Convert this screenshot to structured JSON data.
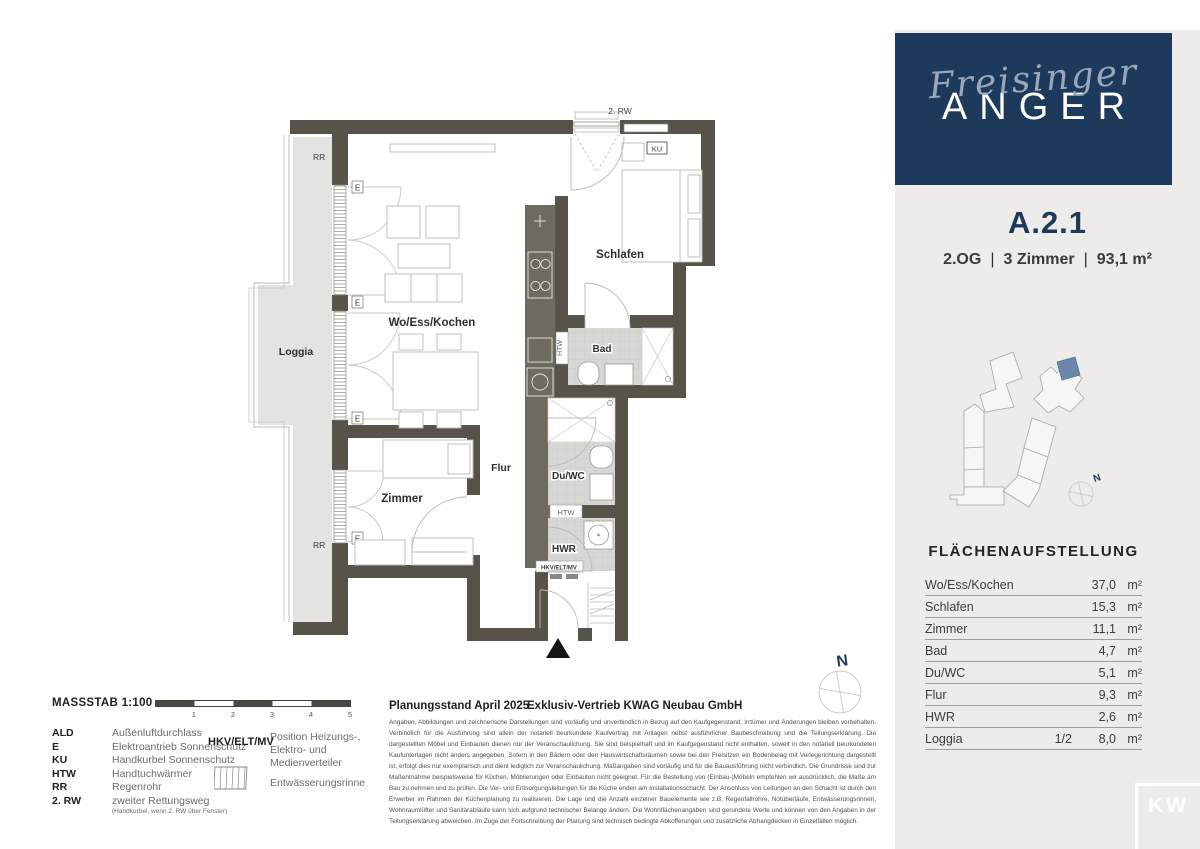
{
  "brand": {
    "script": "Freisinger",
    "caps": "ANGER"
  },
  "unit": {
    "id": "A.2.1",
    "floor": "2.OG",
    "rooms": "3 Zimmer",
    "area": "93,1 m²",
    "separator": "|"
  },
  "plan": {
    "rooms": {
      "wo": "Wo/Ess/Kochen",
      "schlafen": "Schlafen",
      "zimmer": "Zimmer",
      "bad": "Bad",
      "duwc": "Du/WC",
      "flur": "Flur",
      "hwr": "HWR",
      "loggia": "Loggia"
    },
    "annotations": {
      "rw2": "2. RW",
      "e": "E",
      "ku": "KU",
      "htw": "HTW",
      "hkv": "HKV/ELT/MV",
      "rr": "RR",
      "rinne": "Rinne",
      "north": "N"
    }
  },
  "site_plan": {
    "north": "N",
    "highlight_color": "#6b87ab"
  },
  "area_table": {
    "title": "FLÄCHENAUFSTELLUNG",
    "rows": [
      {
        "label": "Wo/Ess/Kochen",
        "fraction": "",
        "value": "37,0",
        "unit": "m²"
      },
      {
        "label": "Schlafen",
        "fraction": "",
        "value": "15,3",
        "unit": "m²"
      },
      {
        "label": "Zimmer",
        "fraction": "",
        "value": "11,1",
        "unit": "m²"
      },
      {
        "label": "Bad",
        "fraction": "",
        "value": "4,7",
        "unit": "m²"
      },
      {
        "label": "Du/WC",
        "fraction": "",
        "value": "5,1",
        "unit": "m²"
      },
      {
        "label": "Flur",
        "fraction": "",
        "value": "9,3",
        "unit": "m²"
      },
      {
        "label": "HWR",
        "fraction": "",
        "value": "2,6",
        "unit": "m²"
      },
      {
        "label": "Loggia",
        "fraction": "1/2",
        "value": "8,0",
        "unit": "m²"
      }
    ]
  },
  "legend": {
    "massstab": "MASSSTAB 1:100",
    "scale_ticks": [
      "1",
      "2",
      "3",
      "4",
      "5"
    ],
    "items": [
      {
        "abbr": "ALD",
        "desc": "Außenluftdurchlass"
      },
      {
        "abbr": "E",
        "desc": "Elektroantrieb Sonnenschutz"
      },
      {
        "abbr": "KU",
        "desc": "Handkurbel Sonnenschutz"
      },
      {
        "abbr": "HTW",
        "desc": "Handtuchwärmer"
      },
      {
        "abbr": "RR",
        "desc": "Regenrohr"
      },
      {
        "abbr": "2. RW",
        "desc": "zweiter Rettungsweg",
        "note": "(Handkurbel, wenn 2. RW über Fenster)"
      }
    ],
    "hkv_abbr": "HKV/ELT/MV",
    "hkv_desc": "Position Heizungs-, Elektro- und Medienverteiler",
    "rinne_desc": "Entwässerungsrinne"
  },
  "footer": {
    "planungsstand": "Planungsstand April 2025",
    "vertrieb": "Exklusiv-Vertrieb  KWAG Neubau GmbH",
    "disclaimer": "Angaben, Abbildungen und zeichnerische Darstellungen sind vorläufig und unverbindlich in Bezug auf den Kaufgegenstand. Irrtümer und Änderungen bleiben vorbehalten. Verbindlich für die Ausführung sind allein der notariell beurkundete Kaufvertrag mit Anlagen nebst ausführlicher Baubeschreibung und die Teilungserklärung. Die dargestellten Möbel und Einbauten dienen nur der Veranschaulichung. Sie sind beispielhaft und im Kaufgegenstand nicht enthalten, soweit in den notariell beurkundeten Kaufunterlagen nicht anders angegeben. Sofern in den Bädern oder den Hauswirtschaftsräumen sowie bei den Freisitzen ein Bodenbelag mit Verlegerichtung dargestellt ist, erfolgt dies nur exemplarisch und dient lediglich zur Veranschaulichung. Maßangaben sind vorläufig und für die Bauausführung nicht verbindlich. Die Grundrisse sind zur Maßentnahme beispielsweise für Küchen, Möblierungen oder Einbauten nicht geeignet. Für die Bestellung von (Einbau-)Möbeln empfehlen wir ausdrücklich, die Maße am Bau zu nehmen und zu prüfen. Die Ver- und Entsorgungsleitungen für die Küche enden am Installationsschacht. Der Anschluss von Leitungen an den Schacht ist durch den Erwerber im Rahmen der Küchenplanung zu realisieren. Die Lage und die Anzahl einzelner Bauelemente wie z.B. Regenfallrohre, Notüberläufe, Entwässerungsrinnen, Wohnraumlüfter und Sanitärabläufe kann sich aufgrund technischer Belange ändern. Die Wohnflächenangaben sind gerundete Werte und können von den Angaben in der Teilungserklärung abweichen. Im Zuge der Fortschreibung der Planung sind technisch bedingte Abkofferungen und zusätzliche Abhangdecken in Einzelfällen möglich."
  },
  "partner_logo": "KW",
  "colors": {
    "navy": "#1d3a5c",
    "wall": "#57534a",
    "panel": "#edecea",
    "tile": "#d8d7d3",
    "loggia": "#e4e3df",
    "highlight": "#6b87ab"
  }
}
